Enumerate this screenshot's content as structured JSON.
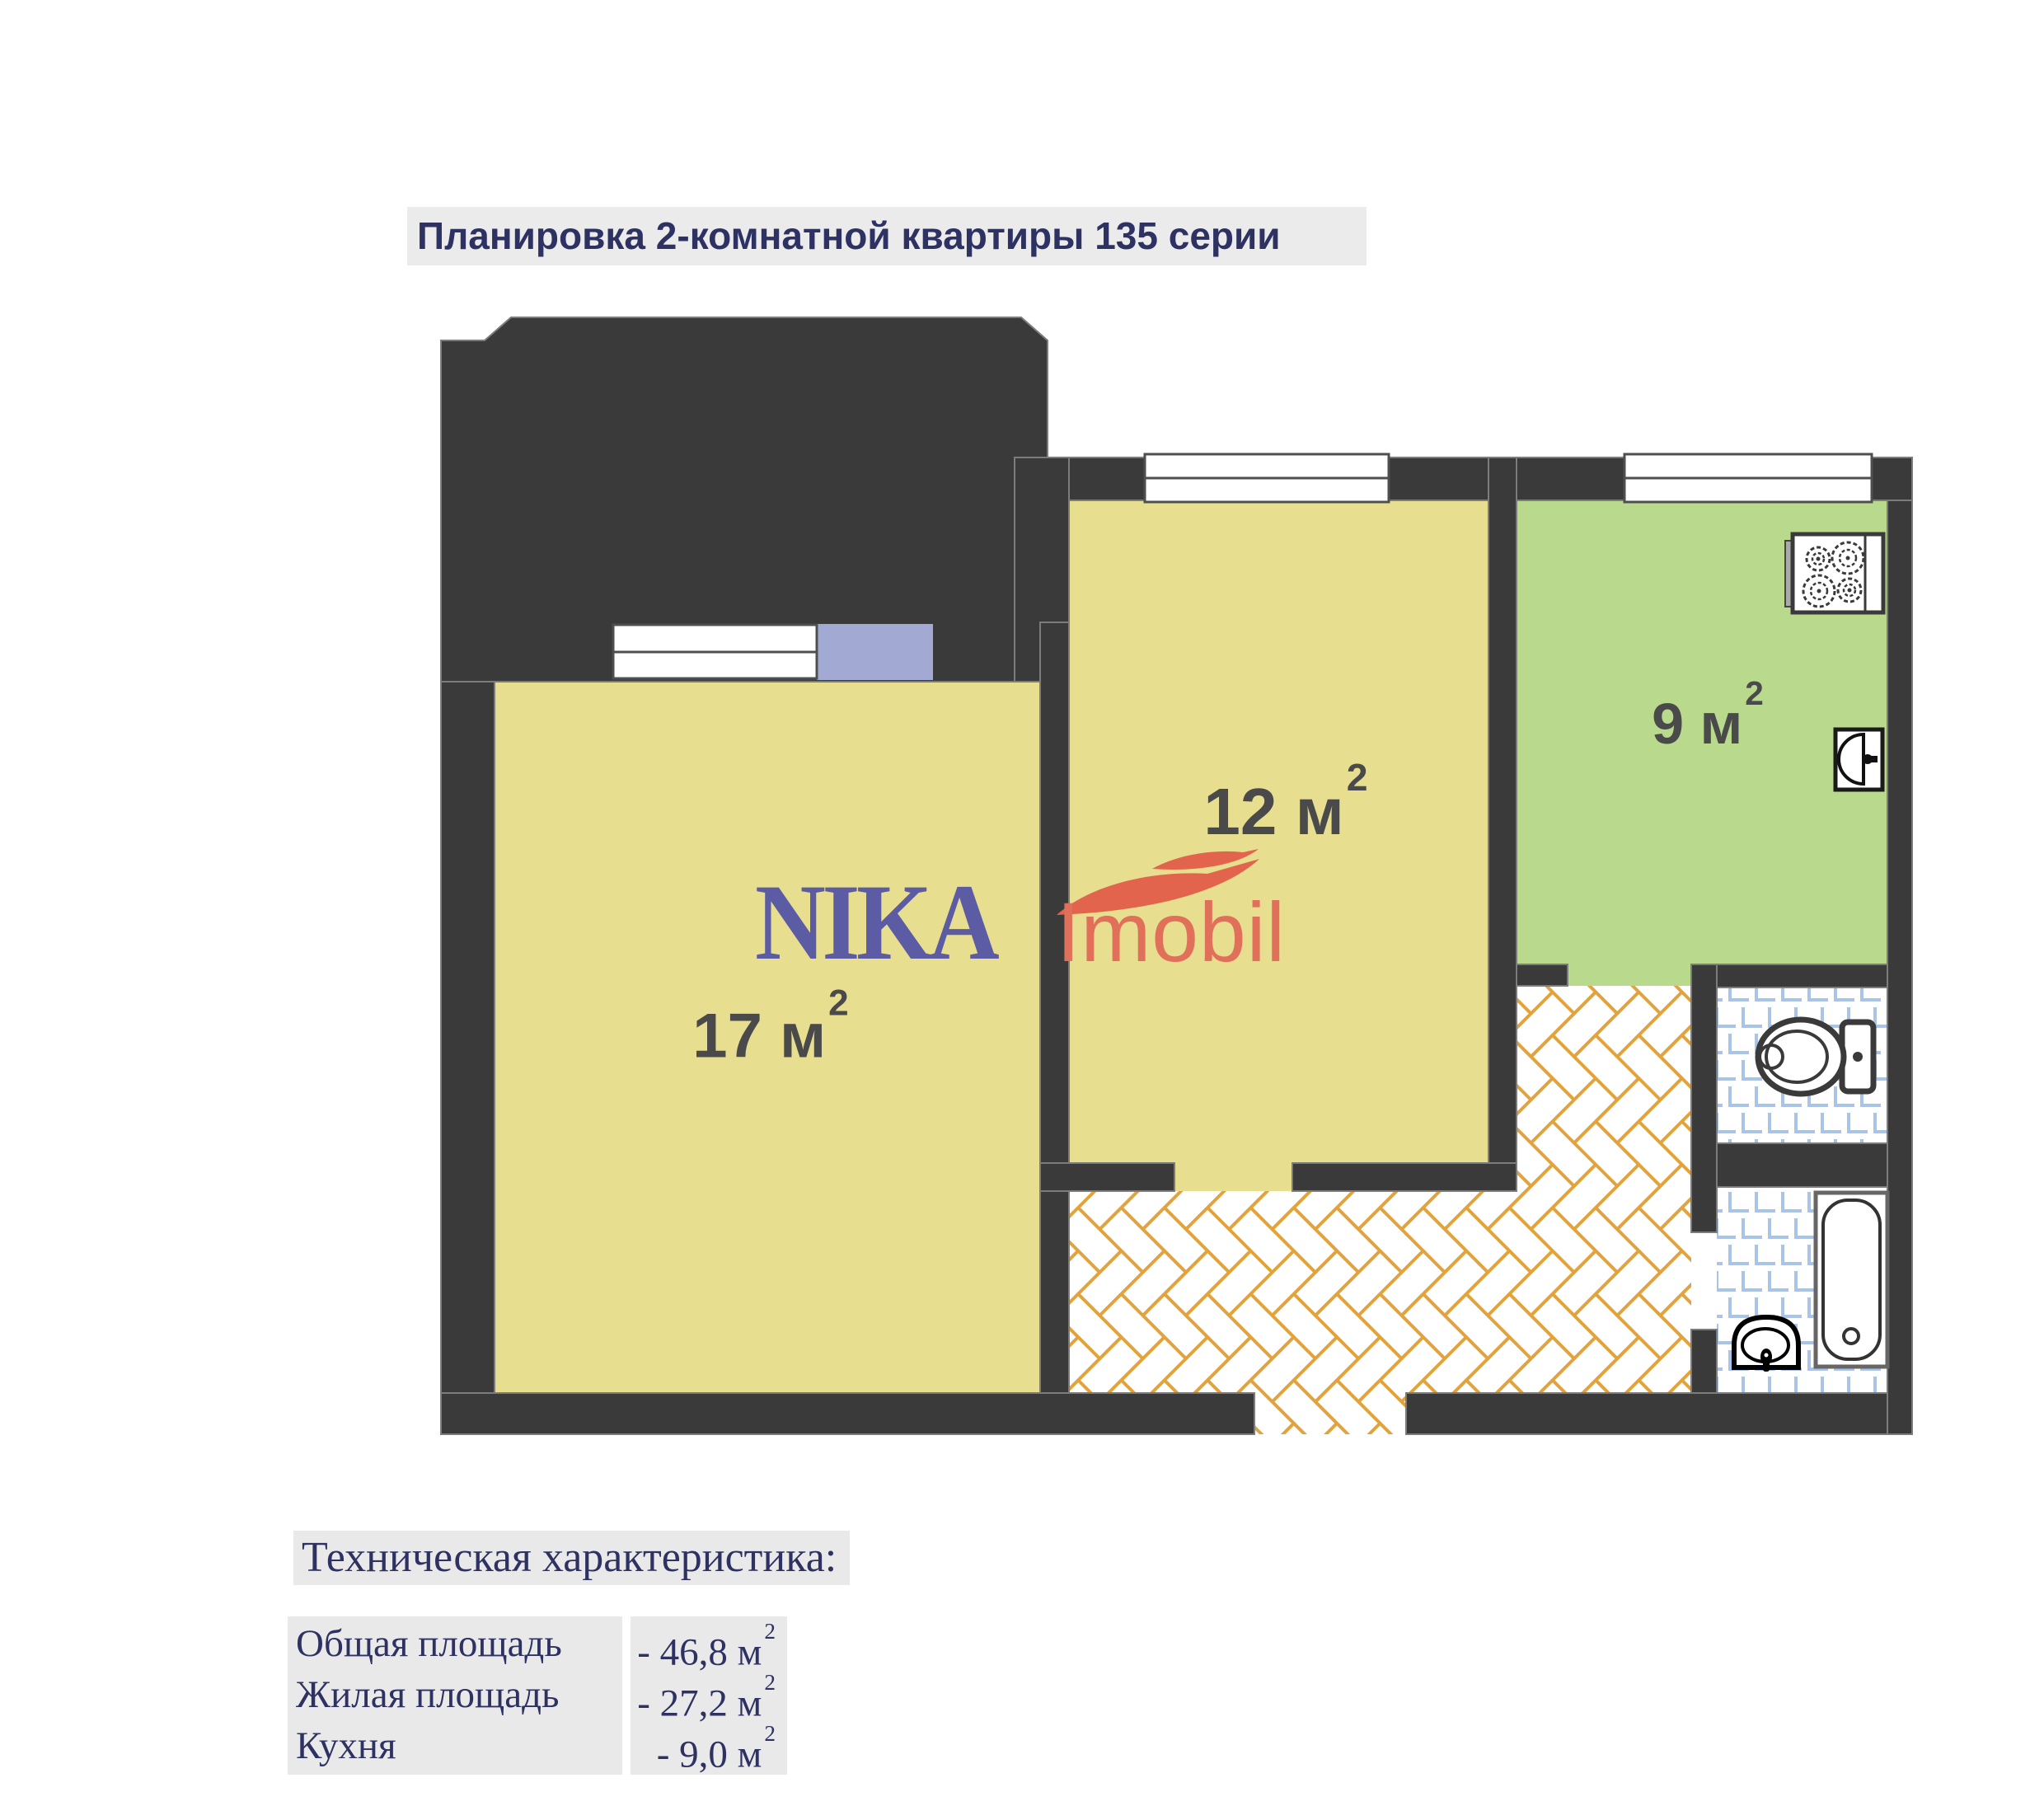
{
  "title": "Планировка 2-комнатной квартиры 135 серии",
  "logo": {
    "name": "NIKA",
    "suffix": "Imobil"
  },
  "plan": {
    "rooms": [
      {
        "id": "room-17",
        "label": "17 м",
        "sup": "2"
      },
      {
        "id": "room-12",
        "label": "12 м",
        "sup": "2"
      },
      {
        "id": "kitchen",
        "label": "9 м",
        "sup": "2"
      }
    ]
  },
  "specs": {
    "heading": "Техническая характеристика:",
    "rows": [
      {
        "label": "Общая площадь",
        "value": "- 46,8 м",
        "sup": "2"
      },
      {
        "label": "Жилая площадь",
        "value": "- 27,2 м",
        "sup": "2"
      },
      {
        "label": "Кухня",
        "value": "- 9,0 м",
        "sup": "2"
      }
    ]
  },
  "colors": {
    "wall": "#3a3a3a",
    "room_yellow": "#e8de90",
    "kitchen_green": "#b9da8d",
    "balcony_lavender": "#a2aad3",
    "tile_blue": "#a9c4e6",
    "parquet_orange": "#e2a33c",
    "heading_navy": "#2e3263",
    "logo_purple": "#5c5ca5",
    "logo_orange": "#e0705a",
    "swoosh_red": "#e2644c",
    "label_gray": "#4a4a4a",
    "highlight_gray": "#ebebeb",
    "table_gray": "#e9e9e9"
  }
}
